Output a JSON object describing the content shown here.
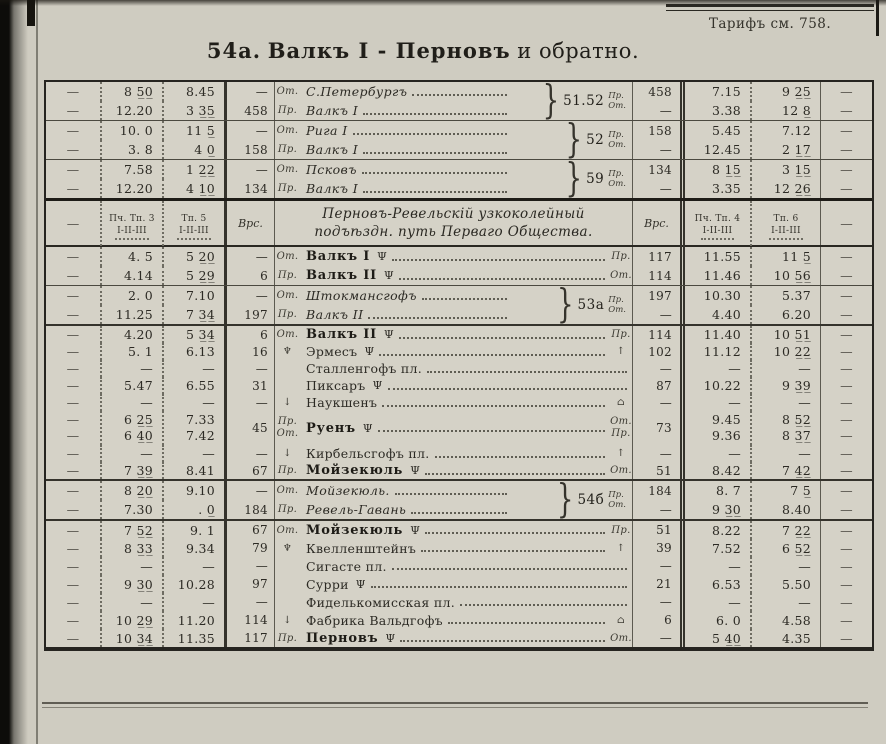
{
  "page": {
    "tariff_note": "Тарифъ см. 758.",
    "title_num": "54а.",
    "title_main": "Валкъ I - Перновъ",
    "title_suffix": "и обратно.",
    "paper_color": "#cfccc1",
    "ink_color": "#2f2d27"
  },
  "symbols": {
    "dash": "—",
    "buffet_icon": "Ψ",
    "signal_icon": "♆",
    "arrow_up_icon": "↑",
    "arrow_down_icon": "↓",
    "building_icon": "⌂",
    "brace": "}"
  },
  "table_header": {
    "dash": "—",
    "train_left_1": "Пч. Тп. 3",
    "train_left_2": "Тп. 5",
    "classes": "І-ІІ-ІІІ",
    "versts": "Врс.",
    "line_title_1": "Перновъ-Ревельскій узкоколейный",
    "line_title_2": "подъѣздн. путь Перваго Общества.",
    "train_right_1": "Пч. Тп. 4",
    "train_right_2": "Тп. 6"
  },
  "route_dir_labels": [
    "Пр.",
    "От."
  ],
  "sections": {
    "A": {
      "groups": [
        {
          "route": "51.52",
          "rows": [
            {
              "t1": "8 5̲0̲",
              "t2": "8.45",
              "vl": "—",
              "dir": "От.",
              "st": "С.Петербургъ",
              "sty": "i",
              "vr": "458",
              "t3": "7.15",
              "t4": "9 2̲5̲"
            },
            {
              "t1": "12.20",
              "t2": "3 3̲5̲",
              "vl": "458",
              "dir": "Пр.",
              "st": "Валкъ I",
              "sty": "i",
              "vr": "—",
              "t3": "3.38",
              "t4": "12 8̲"
            }
          ]
        },
        {
          "route": "52",
          "rows": [
            {
              "t1": "10. 0",
              "t2": "11 5̲",
              "vl": "—",
              "dir": "От.",
              "st": "Рига I",
              "sty": "i",
              "vr": "158",
              "t3": "5.45",
              "t4": "7.12"
            },
            {
              "t1": "3. 8",
              "t2": "4 0̲",
              "vl": "158",
              "dir": "Пр.",
              "st": "Валкъ I",
              "sty": "i",
              "vr": "—",
              "t3": "12.45",
              "t4": "2 1̲7̲"
            }
          ]
        },
        {
          "route": "59",
          "rows": [
            {
              "t1": "7.58",
              "t2": "1 2̲2̲",
              "vl": "—",
              "dir": "От.",
              "st": "Псковъ",
              "sty": "i",
              "vr": "134",
              "t3": "8 1̲5̲",
              "t4": "3 1̲5̲"
            },
            {
              "t1": "12.20",
              "t2": "4 1̲0̲",
              "vl": "134",
              "dir": "Пр.",
              "st": "Валкъ I",
              "sty": "i",
              "vr": "—",
              "t3": "3.35",
              "t4": "12 2̲6̲"
            }
          ]
        }
      ]
    },
    "B": {
      "groups": [
        {
          "route": null,
          "rows": [
            {
              "t1": "4. 5",
              "t2": "5 2̲0̲",
              "vl": "—",
              "dir": "От.",
              "st": "Валкъ I",
              "sty": "b",
              "buf": true,
              "end": "Пр.",
              "vr": "117",
              "t3": "11.55",
              "t4": "11 5̲"
            },
            {
              "t1": "4.14",
              "t2": "5 2̲9̲",
              "vl": "6",
              "dir": "Пр.",
              "st": "Валкъ II",
              "sty": "b",
              "buf": true,
              "end": "От.",
              "vr": "114",
              "t3": "11.46",
              "t4": "10 5̲6̲"
            }
          ]
        },
        {
          "route": "53а",
          "rows": [
            {
              "t1": "2. 0",
              "t2": "7.10",
              "vl": "—",
              "dir": "От.",
              "st": "Штокмансгофъ",
              "sty": "i",
              "vr": "197",
              "t3": "10.30",
              "t4": "5.37"
            },
            {
              "t1": "11.25",
              "t2": "7 3̲4̲",
              "vl": "197",
              "dir": "Пр.",
              "st": "Валкъ II",
              "sty": "i",
              "vr": "—",
              "t3": "4.40",
              "t4": "6.20"
            }
          ]
        }
      ]
    },
    "C": {
      "groups": [
        {
          "route": null,
          "rows": [
            {
              "t1": "4.20",
              "t2": "5 3̲4̲",
              "vl": "6",
              "dir": "От.",
              "st": "Валкъ II",
              "sty": "b",
              "buf": true,
              "end": "Пр.",
              "vr": "114",
              "t3": "11.40",
              "t4": "10 5̲1̲"
            },
            {
              "t1": "5. 1",
              "t2": "6.13",
              "vl": "16",
              "dir": "♆",
              "st": "Эрмесъ",
              "sty": "",
              "buf": true,
              "end": "↑",
              "vr": "102",
              "t3": "11.12",
              "t4": "10 2̲2̲"
            },
            {
              "t1": "—",
              "t2": "—",
              "vl": "—",
              "dir": "",
              "st": "Сталленгофъ пл.",
              "sty": "",
              "vr": "—",
              "t3": "—",
              "t4": "—"
            },
            {
              "t1": "5.47",
              "t2": "6.55",
              "vl": "31",
              "dir": "",
              "st": "Пиксаръ",
              "sty": "",
              "buf": true,
              "vr": "87",
              "t3": "10.22",
              "t4": "9 3̲9̲"
            },
            {
              "t1": "—",
              "t2": "—",
              "vl": "—",
              "dir": "↓",
              "st": "Наукшенъ",
              "sty": "",
              "end": "⌂",
              "vr": "—",
              "t3": "—",
              "t4": "—"
            },
            {
              "dbl": true,
              "d1": [
                "—",
                "—"
              ],
              "d2": [
                "—",
                "—"
              ],
              "t1": [
                "6 2̲5̲",
                "6 4̲0̲"
              ],
              "t2": [
                "7.33",
                "7.42"
              ],
              "vl": "45",
              "dir": [
                "Пр.",
                "От."
              ],
              "st": "Руенъ",
              "sty": "b",
              "buf": true,
              "end": [
                "От.",
                "Пр."
              ],
              "vr": "73",
              "t3": [
                "9.45",
                "9.36"
              ],
              "t4": [
                "8 5̲2̲",
                "8 3̲7̲"
              ]
            },
            {
              "t1": "—",
              "t2": "—",
              "vl": "—",
              "dir": "↓",
              "st": "Кирбельсгофъ пл.",
              "sty": "",
              "end": "↑",
              "vr": "—",
              "t3": "—",
              "t4": "—"
            },
            {
              "t1": "7 3̲9̲",
              "t2": "8.41",
              "vl": "67",
              "dir": "Пр.",
              "st": "Мойзекюль",
              "sty": "b",
              "buf": true,
              "end": "От.",
              "vr": "51",
              "t3": "8.42",
              "t4": "7 4̲2̲"
            }
          ]
        }
      ]
    },
    "D": {
      "groups": [
        {
          "route": "54б",
          "rows": [
            {
              "t1": "8 2̲0̲",
              "t2": "9.10",
              "vl": "—",
              "dir": "От.",
              "st": "Мойзекюль.",
              "sty": "i",
              "vr": "184",
              "t3": "8. 7",
              "t4": "7 5̲"
            },
            {
              "t1": "7.30",
              "t2": ". 0̲",
              "vl": "184",
              "dir": "Пр.",
              "st": "Ревель-Гавань",
              "sty": "i",
              "vr": "—",
              "t3": "9 3̲0̲",
              "t4": "8.40"
            }
          ]
        }
      ]
    },
    "E": {
      "groups": [
        {
          "route": null,
          "rows": [
            {
              "t1": "7 5̲2̲",
              "t2": "9. 1",
              "vl": "67",
              "dir": "От.",
              "st": "Мойзекюль",
              "sty": "b",
              "buf": true,
              "end": "Пр.",
              "vr": "51",
              "t3": "8.22",
              "t4": "7 2̲2̲"
            },
            {
              "t1": "8 3̲3̲",
              "t2": "9.34",
              "vl": "79",
              "dir": "♆",
              "st": "Квелленштейнъ",
              "sty": "",
              "end": "↑",
              "vr": "39",
              "t3": "7.52",
              "t4": "6 5̲2̲"
            },
            {
              "t1": "—",
              "t2": "—",
              "vl": "—",
              "dir": "",
              "st": "Сигасте пл.",
              "sty": "",
              "vr": "—",
              "t3": "—",
              "t4": "—"
            },
            {
              "t1": "9 3̲0̲",
              "t2": "10.28",
              "vl": "97",
              "dir": "",
              "st": "Сурри",
              "sty": "",
              "buf": true,
              "vr": "21",
              "t3": "6.53",
              "t4": "5.50"
            },
            {
              "t1": "—",
              "t2": "—",
              "vl": "—",
              "dir": "",
              "st": "Фиделькомисская пл.",
              "sty": "",
              "vr": "—",
              "t3": "—",
              "t4": "—"
            },
            {
              "t1": "10 2̲9̲",
              "t2": "11.20",
              "vl": "114",
              "dir": "↓",
              "st": "Фабрика Вальдгофъ",
              "sty": "",
              "end": "⌂",
              "vr": "6",
              "t3": "6. 0",
              "t4": "4.58"
            },
            {
              "t1": "10 3̲4̲",
              "t2": "11.35",
              "vl": "117",
              "dir": "Пр.",
              "st": "Перновъ",
              "sty": "b",
              "buf": true,
              "end": "От.",
              "vr": "—",
              "t3": "5 4̲0̲",
              "t4": "4.35"
            }
          ]
        }
      ]
    }
  }
}
